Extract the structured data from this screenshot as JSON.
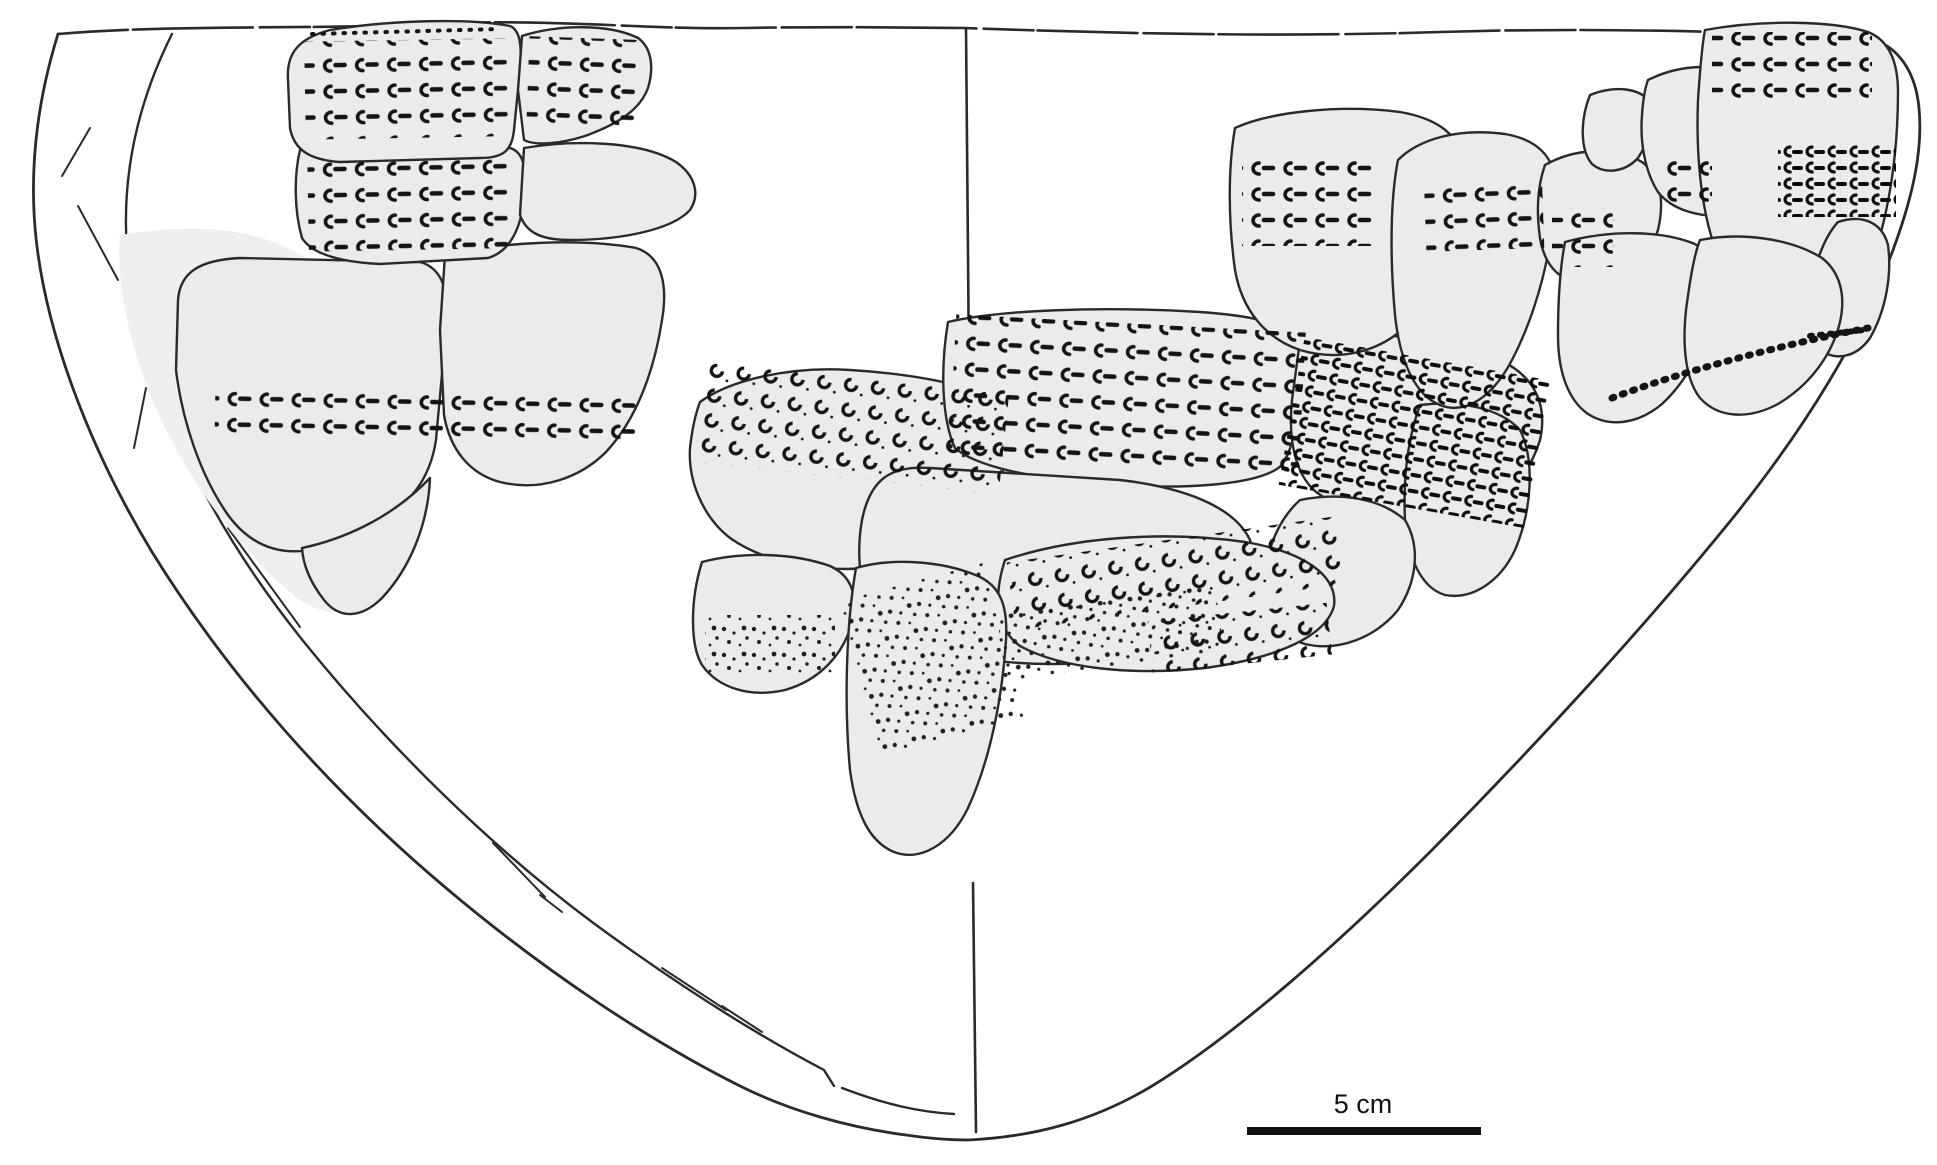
{
  "figure": {
    "kind": "archaeological-vessel-reconstruction-drawing",
    "scale_bar": {
      "label": "5 cm"
    },
    "colors": {
      "background": "#ffffff",
      "sherd_fill": "#ebebeb",
      "ghost_fill": "#efefef",
      "outline": "#2a2a2a",
      "stamp_ink": "#141414",
      "scale_bar_ink": "#111111"
    }
  }
}
